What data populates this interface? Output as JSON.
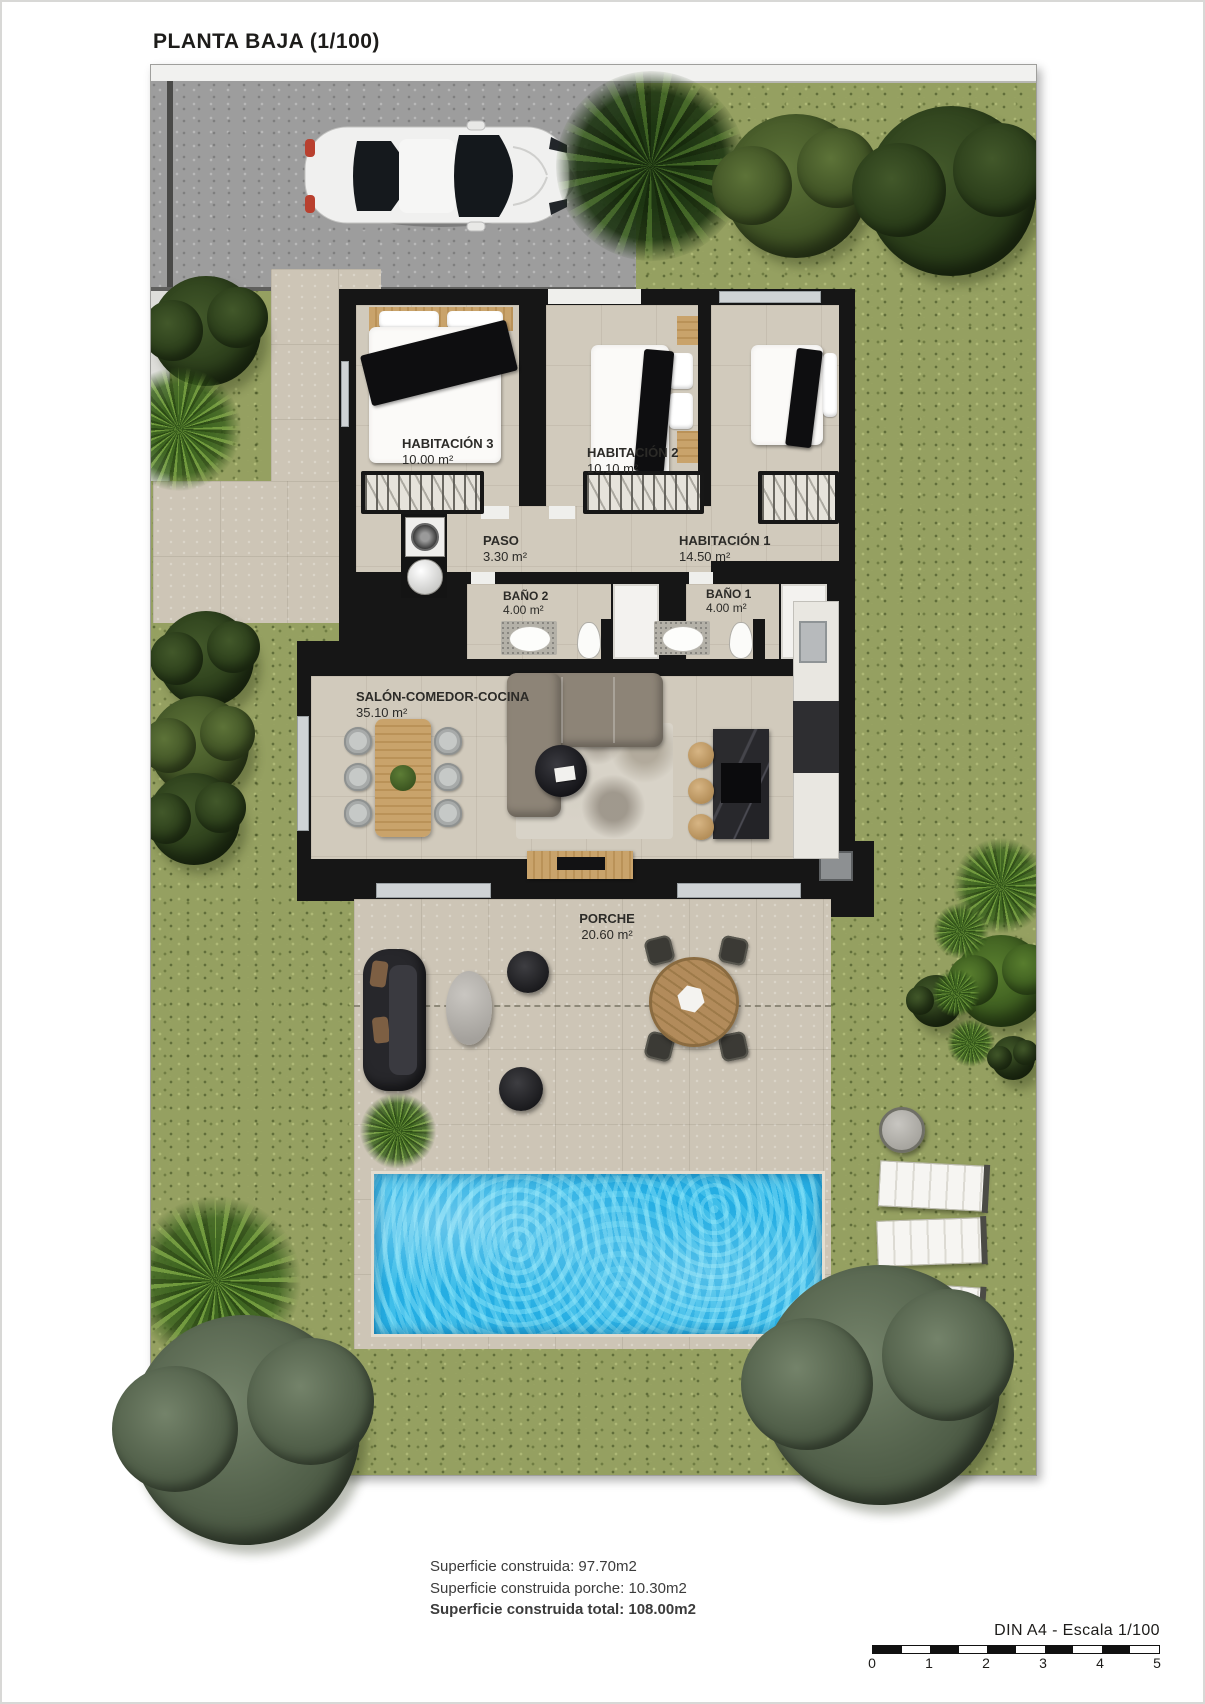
{
  "title": "PLANTA BAJA (1/100)",
  "rooms": {
    "hab3": {
      "name": "HABITACIÓN 3",
      "area": "10.00 m²"
    },
    "hab2": {
      "name": "HABITACIÓN 2",
      "area": "10.10 m²"
    },
    "hab1": {
      "name": "HABITACIÓN 1",
      "area": "14.50 m²"
    },
    "paso": {
      "name": "PASO",
      "area": "3.30 m²"
    },
    "bano2": {
      "name": "BAÑO 2",
      "area": "4.00 m²"
    },
    "bano1": {
      "name": "BAÑO 1",
      "area": "4.00 m²"
    },
    "salon": {
      "name": "SALÓN-COMEDOR-COCINA",
      "area": "35.10 m²"
    },
    "porche": {
      "name": "PORCHE",
      "area": "20.60 m²"
    }
  },
  "summary": {
    "line1": "Superficie construida: 97.70m2",
    "line2": "Superficie construida porche: 10.30m2",
    "line3": "Superficie construida total: 108.00m2"
  },
  "scale": {
    "label": "DIN A4 - Escala 1/100",
    "ticks": [
      "0",
      "1",
      "2",
      "3",
      "4",
      "5"
    ]
  },
  "colors": {
    "grass": "#95a061",
    "paving": "#cdc5b6",
    "wall": "#161616",
    "pool": "#25aee3",
    "driveway": "#9d9d9d"
  }
}
